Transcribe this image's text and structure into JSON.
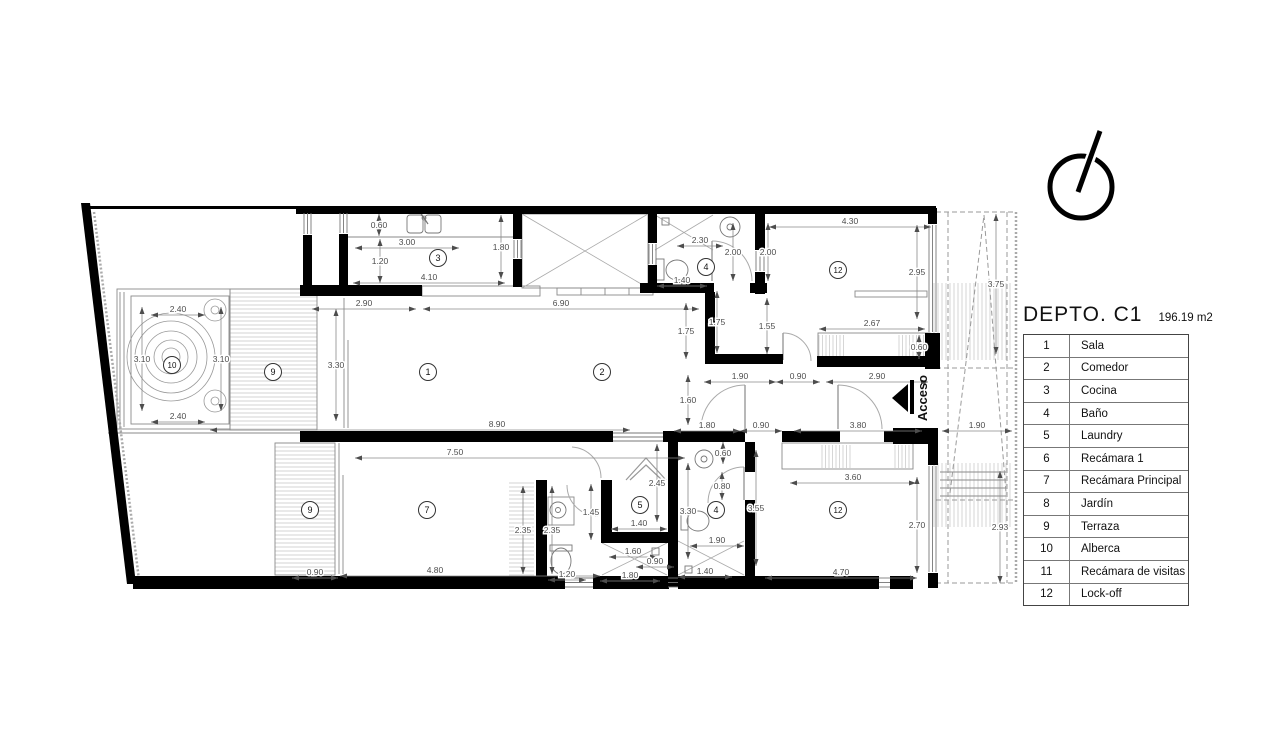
{
  "header": {
    "title": "DEPTO. C1",
    "area": "196.19 m2"
  },
  "legend": [
    {
      "num": "1",
      "name": "Sala"
    },
    {
      "num": "2",
      "name": "Comedor"
    },
    {
      "num": "3",
      "name": "Cocina"
    },
    {
      "num": "4",
      "name": "Baño"
    },
    {
      "num": "5",
      "name": "Laundry"
    },
    {
      "num": "6",
      "name": "Recámara 1"
    },
    {
      "num": "7",
      "name": "Recámara Principal"
    },
    {
      "num": "8",
      "name": "Jardín"
    },
    {
      "num": "9",
      "name": "Terraza"
    },
    {
      "num": "10",
      "name": "Alberca"
    },
    {
      "num": "11",
      "name": "Recámara de visitas"
    },
    {
      "num": "12",
      "name": "Lock-off"
    }
  ],
  "access_label": "Acceso",
  "colors": {
    "walls": "#000000",
    "dims": "#4d4d4d",
    "dimline": "#8a8a8a",
    "hatch": "#c4c4c4",
    "thin": "#8a8a8a",
    "dashed": "#9a9a9a"
  },
  "plan": {
    "room_bubbles": [
      {
        "n": "3",
        "x": 438,
        "y": 258
      },
      {
        "n": "4",
        "x": 706,
        "y": 267
      },
      {
        "n": "12",
        "x": 838,
        "y": 270
      },
      {
        "n": "10",
        "x": 172,
        "y": 365
      },
      {
        "n": "9",
        "x": 273,
        "y": 372
      },
      {
        "n": "1",
        "x": 428,
        "y": 372
      },
      {
        "n": "2",
        "x": 602,
        "y": 372
      },
      {
        "n": "9",
        "x": 310,
        "y": 510
      },
      {
        "n": "7",
        "x": 427,
        "y": 510
      },
      {
        "n": "5",
        "x": 640,
        "y": 505
      },
      {
        "n": "4",
        "x": 716,
        "y": 510
      },
      {
        "n": "12",
        "x": 838,
        "y": 510
      }
    ],
    "dimensions": [
      {
        "t": "0.60",
        "x": 379,
        "y": 225,
        "o": "v",
        "l": 22
      },
      {
        "t": "3.00",
        "x": 407,
        "y": 242,
        "o": "h",
        "l": 104
      },
      {
        "t": "1.20",
        "x": 380,
        "y": 261,
        "o": "v",
        "l": 44
      },
      {
        "t": "4.10",
        "x": 429,
        "y": 277,
        "o": "h",
        "l": 152
      },
      {
        "t": "1.80",
        "x": 501,
        "y": 247,
        "o": "v",
        "l": 64
      },
      {
        "t": "2.90",
        "x": 364,
        "y": 303,
        "o": "h",
        "l": 104
      },
      {
        "t": "6.90",
        "x": 561,
        "y": 303,
        "o": "h",
        "l": 276
      },
      {
        "t": "2.40",
        "x": 178,
        "y": 309,
        "o": "h",
        "l": 54
      },
      {
        "t": "3.10",
        "x": 142,
        "y": 359,
        "o": "v",
        "l": 104
      },
      {
        "t": "3.10",
        "x": 221,
        "y": 359,
        "o": "v",
        "l": 104
      },
      {
        "t": "2.40",
        "x": 178,
        "y": 416,
        "o": "h",
        "l": 54
      },
      {
        "t": "3.30",
        "x": 336,
        "y": 365,
        "o": "v",
        "l": 112
      },
      {
        "t": "8.90",
        "x": 497,
        "y": 424,
        "o": "h",
        "l": 420,
        "cx": 420
      },
      {
        "t": "1.75",
        "x": 686,
        "y": 331,
        "o": "v",
        "l": 56
      },
      {
        "t": "1.75",
        "x": 717,
        "y": 322,
        "o": "v",
        "l": 62
      },
      {
        "t": "1.55",
        "x": 767,
        "y": 326,
        "o": "v",
        "l": 56
      },
      {
        "t": "2.67",
        "x": 872,
        "y": 323,
        "o": "h",
        "l": 106
      },
      {
        "t": "0.60",
        "x": 919,
        "y": 347,
        "o": "v",
        "l": 24
      },
      {
        "t": "4.30",
        "x": 850,
        "y": 221,
        "o": "h",
        "l": 162
      },
      {
        "t": "2.95",
        "x": 917,
        "y": 272,
        "o": "v",
        "l": 94
      },
      {
        "t": "2.30",
        "x": 700,
        "y": 240,
        "o": "h",
        "l": 46
      },
      {
        "t": "2.00",
        "x": 733,
        "y": 252,
        "o": "v",
        "l": 58
      },
      {
        "t": "2.00",
        "x": 768,
        "y": 252,
        "o": "v",
        "l": 58
      },
      {
        "t": "1.40",
        "x": 682,
        "y": 280,
        "o": "h",
        "l": 50
      },
      {
        "t": "1.90",
        "x": 977,
        "y": 425,
        "o": "h",
        "l": 70
      },
      {
        "t": "3.75",
        "x": 996,
        "y": 284,
        "o": "v",
        "l": 140
      },
      {
        "t": "1.90",
        "x": 740,
        "y": 376,
        "o": "h",
        "l": 72
      },
      {
        "t": "0.90",
        "x": 798,
        "y": 376,
        "o": "h",
        "l": 44
      },
      {
        "t": "2.90",
        "x": 877,
        "y": 376,
        "o": "h",
        "l": 102
      },
      {
        "t": "1.60",
        "x": 688,
        "y": 400,
        "o": "v",
        "l": 50
      },
      {
        "t": "1.80",
        "x": 707,
        "y": 425,
        "o": "h",
        "l": 66
      },
      {
        "t": "0.90",
        "x": 761,
        "y": 425,
        "o": "h",
        "l": 42
      },
      {
        "t": "3.80",
        "x": 858,
        "y": 425,
        "o": "h",
        "l": 128
      },
      {
        "t": "7.50",
        "x": 455,
        "y": 452,
        "o": "h",
        "l": 330,
        "cx": 520
      },
      {
        "t": "0.90",
        "x": 315,
        "y": 572,
        "o": "h",
        "l": 46
      },
      {
        "t": "4.80",
        "x": 435,
        "y": 570,
        "o": "h",
        "l": 260,
        "cx": 470
      },
      {
        "t": "2.35",
        "x": 523,
        "y": 530,
        "o": "v",
        "l": 88
      },
      {
        "t": "2.35",
        "x": 552,
        "y": 530,
        "o": "v",
        "l": 88
      },
      {
        "t": "1.45",
        "x": 591,
        "y": 512,
        "o": "v",
        "l": 56
      },
      {
        "t": "1.20",
        "x": 567,
        "y": 574,
        "o": "h",
        "l": 38
      },
      {
        "t": "1.80",
        "x": 630,
        "y": 575,
        "o": "h",
        "l": 60
      },
      {
        "t": "1.60",
        "x": 633,
        "y": 551,
        "o": "h",
        "l": 48
      },
      {
        "t": "0.90",
        "x": 655,
        "y": 561,
        "o": "h",
        "l": 38
      },
      {
        "t": "1.40",
        "x": 639,
        "y": 523,
        "o": "h",
        "l": 56
      },
      {
        "t": "2.45",
        "x": 657,
        "y": 483,
        "o": "v",
        "l": 78
      },
      {
        "t": "0.60",
        "x": 723,
        "y": 453,
        "o": "v",
        "l": 22
      },
      {
        "t": "0.80",
        "x": 722,
        "y": 486,
        "o": "v",
        "l": 28
      },
      {
        "t": "3.30",
        "x": 688,
        "y": 511,
        "o": "v",
        "l": 96
      },
      {
        "t": "1.90",
        "x": 717,
        "y": 540,
        "o": "h",
        "l": 54
      },
      {
        "t": "1.40",
        "x": 705,
        "y": 571,
        "o": "h",
        "l": 54
      },
      {
        "t": "3.55",
        "x": 756,
        "y": 508,
        "o": "v",
        "l": 116
      },
      {
        "t": "3.60",
        "x": 853,
        "y": 477,
        "o": "h",
        "l": 126
      },
      {
        "t": "2.70",
        "x": 917,
        "y": 525,
        "o": "v",
        "l": 96
      },
      {
        "t": "4.70",
        "x": 841,
        "y": 572,
        "o": "h",
        "l": 152
      },
      {
        "t": "2.93",
        "x": 1000,
        "y": 527,
        "o": "v",
        "l": 112
      }
    ]
  }
}
